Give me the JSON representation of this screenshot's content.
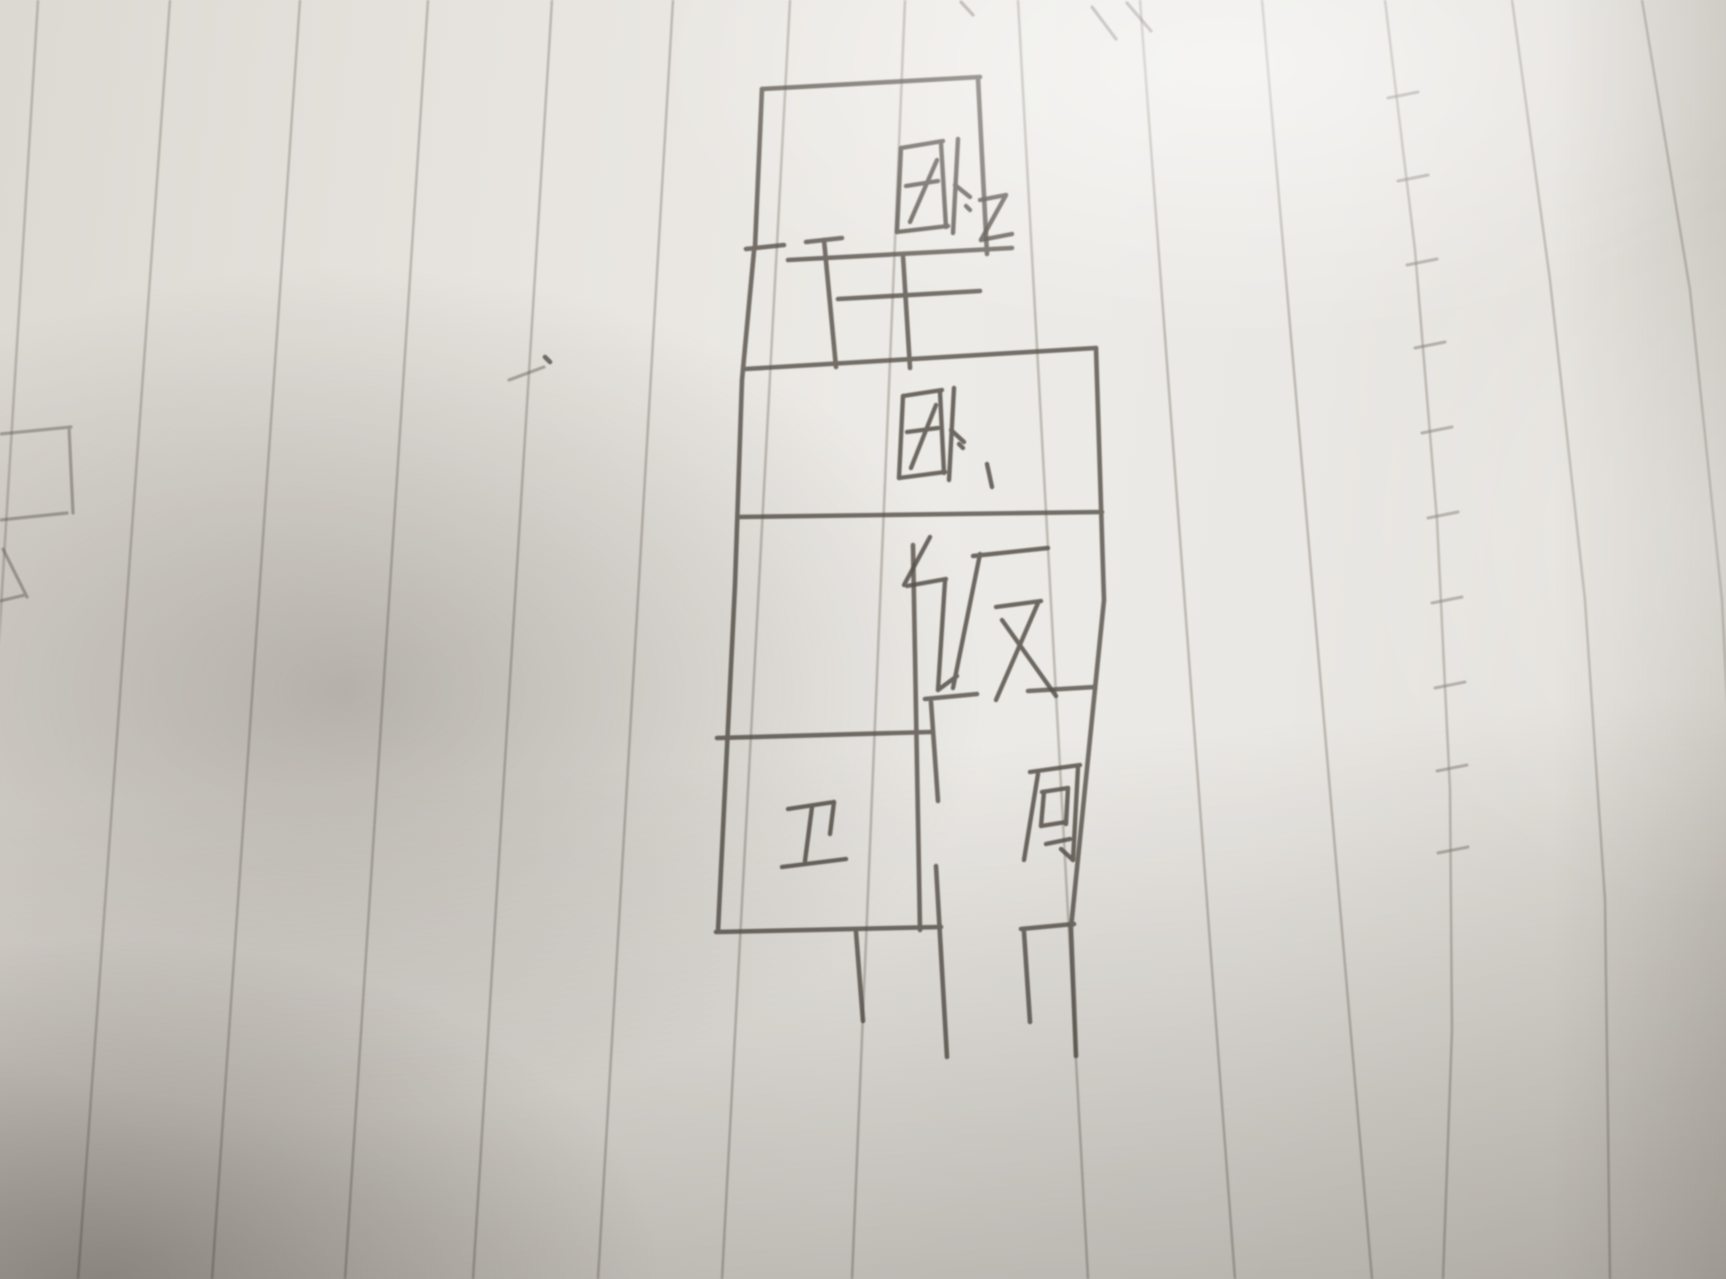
{
  "scene": {
    "description": "Photograph of a hand-drawn apartment floor plan sketched in pencil on slanted ruled notebook paper, with soft uneven lighting and shadow",
    "paper_color": "#eae8e4",
    "rule_line_color": "#a09a92",
    "pencil_color": "#58524b"
  },
  "floor_plan": {
    "rooms": [
      {
        "id": "bedroom-2",
        "label": "卧·2",
        "meaning": "Bedroom 2",
        "position": "top"
      },
      {
        "id": "bedroom-1",
        "label": "卧·1",
        "meaning": "Bedroom 1",
        "position": "upper middle"
      },
      {
        "id": "dining",
        "label": "饭",
        "meaning": "Dining",
        "position": "middle"
      },
      {
        "id": "bathroom",
        "label": "卫",
        "meaning": "Bathroom",
        "position": "lower left"
      },
      {
        "id": "kitchen",
        "label": "厨",
        "meaning": "Kitchen",
        "position": "lower right"
      }
    ]
  },
  "sketch": {
    "groups": [
      {
        "name": "rule-lines",
        "cls": "rule",
        "stroke_name": "rule-line",
        "lines": [
          [
            [
              38,
              0
            ],
            [
              -40,
              1279
            ]
          ],
          [
            [
              170,
              0
            ],
            [
              78,
              1279
            ]
          ],
          [
            [
              300,
              0
            ],
            [
              212,
              1279
            ]
          ],
          [
            [
              428,
              0
            ],
            [
              345,
              1279
            ]
          ],
          [
            [
              552,
              0
            ],
            [
              473,
              1279
            ]
          ],
          [
            [
              673,
              0
            ],
            [
              598,
              1279
            ]
          ],
          [
            [
              790,
              0
            ],
            [
              722,
              1279
            ]
          ],
          [
            [
              905,
              0
            ],
            [
              852,
              1279
            ]
          ],
          [
            [
              1018,
              0
            ],
            [
              1088,
              1279
            ]
          ],
          [
            [
              1140,
              0
            ],
            [
              1235,
              1279
            ]
          ],
          [
            [
              1262,
              0
            ],
            [
              1372,
              1279
            ]
          ],
          [
            [
              1385,
              0
            ],
            [
              1415,
              250
            ],
            [
              1437,
              520
            ],
            [
              1450,
              790
            ],
            [
              1452,
              1030
            ],
            [
              1443,
              1279
            ]
          ],
          [
            [
              1512,
              0
            ],
            [
              1550,
              280
            ],
            [
              1585,
              600
            ],
            [
              1605,
              900
            ],
            [
              1610,
              1279
            ]
          ],
          [
            [
              1642,
              0
            ],
            [
              1690,
              290
            ],
            [
              1722,
              600
            ],
            [
              1730,
              760
            ]
          ]
        ]
      },
      {
        "name": "seam-ticks",
        "cls": "rule-tick",
        "stroke_name": "seam-tick",
        "lines": [
          [
            [
              1388,
              98
            ],
            [
              1418,
              92
            ]
          ],
          [
            [
              1398,
              181
            ],
            [
              1428,
              175
            ]
          ],
          [
            [
              1407,
              265
            ],
            [
              1437,
              259
            ]
          ],
          [
            [
              1415,
              348
            ],
            [
              1445,
              342
            ]
          ],
          [
            [
              1422,
              433
            ],
            [
              1452,
              427
            ]
          ],
          [
            [
              1428,
              518
            ],
            [
              1458,
              512
            ]
          ],
          [
            [
              1432,
              603
            ],
            [
              1462,
              597
            ]
          ],
          [
            [
              1435,
              688
            ],
            [
              1465,
              682
            ]
          ],
          [
            [
              1437,
              771
            ],
            [
              1467,
              765
            ]
          ],
          [
            [
              1438,
              853
            ],
            [
              1468,
              847
            ]
          ]
        ]
      },
      {
        "name": "edge-marks",
        "cls": "pencil faint",
        "stroke_name": "edge-mark",
        "lines": [
          [
            [
              0,
              434
            ],
            [
              71,
              427
            ]
          ],
          [
            [
              69,
              427
            ],
            [
              73,
              513
            ]
          ],
          [
            [
              0,
              520
            ],
            [
              67,
              513
            ]
          ],
          [
            [
              3,
              549
            ],
            [
              27,
              597
            ]
          ],
          [
            [
              0,
              601
            ],
            [
              25,
              595
            ]
          ],
          [
            [
              509,
              380
            ],
            [
              544,
              367
            ]
          ],
          [
            [
              1092,
              7
            ],
            [
              1116,
              39
            ]
          ],
          [
            [
              1127,
              3
            ],
            [
              1151,
              31
            ]
          ],
          [
            [
              961,
              2
            ],
            [
              973,
              15
            ]
          ]
        ]
      },
      {
        "name": "smudge",
        "cls": "pencil wall",
        "stroke_name": "smudge-dot",
        "lines": [
          [
            [
              545,
              357
            ],
            [
              550,
              362
            ]
          ]
        ]
      },
      {
        "name": "walls",
        "cls": "pencil wall",
        "stroke_name": "wall-segment",
        "lines": [
          [
            [
              762,
              89
            ],
            [
              980,
              77
            ]
          ],
          [
            [
              978,
              78
            ],
            [
              987,
              254
            ]
          ],
          [
            [
              788,
              260
            ],
            [
              1012,
              248
            ]
          ],
          [
            [
              762,
              89
            ],
            [
              755,
              247
            ]
          ],
          [
            [
              746,
              249
            ],
            [
              784,
              245
            ]
          ],
          [
            [
              806,
              242
            ],
            [
              842,
              238
            ]
          ],
          [
            [
              824,
              240
            ],
            [
              836,
              367
            ]
          ],
          [
            [
              838,
              299
            ],
            [
              980,
              291
            ]
          ],
          [
            [
              903,
              256
            ],
            [
              910,
              368
            ]
          ],
          [
            [
              754,
              251
            ],
            [
              742,
              380
            ],
            [
              735,
              585
            ],
            [
              718,
              931
            ]
          ],
          [
            [
              745,
              369
            ],
            [
              1096,
              348
            ]
          ],
          [
            [
              1096,
              348
            ],
            [
              1104,
              600
            ],
            [
              1095,
              689
            ]
          ],
          [
            [
              739,
              517
            ],
            [
              1102,
              512
            ]
          ],
          [
            [
              913,
              545
            ],
            [
              920,
              930
            ]
          ],
          [
            [
              1028,
              691
            ],
            [
              1095,
              687
            ]
          ],
          [
            [
              1095,
              689
            ],
            [
              1071,
              928
            ],
            [
              1076,
              1056
            ]
          ],
          [
            [
              925,
              699
            ],
            [
              977,
              694
            ]
          ],
          [
            [
              931,
              702
            ],
            [
              938,
              801
            ]
          ],
          [
            [
              936,
              866
            ],
            [
              947,
              1057
            ]
          ],
          [
            [
              1021,
              929
            ],
            [
              1074,
              924
            ]
          ],
          [
            [
              1024,
              932
            ],
            [
              1030,
              1022
            ]
          ],
          [
            [
              717,
              738
            ],
            [
              931,
              732
            ]
          ],
          [
            [
              716,
              932
            ],
            [
              941,
              927
            ]
          ],
          [
            [
              856,
              932
            ],
            [
              863,
              1021
            ]
          ]
        ]
      },
      {
        "name": "label-bedroom-2",
        "cls": "pencil glyph",
        "stroke_name": "glyph-stroke",
        "lines": [
          [
            [
              901,
              148
            ],
            [
              943,
              141
            ]
          ],
          [
            [
              901,
              148
            ],
            [
              897,
              232
            ]
          ],
          [
            [
              897,
              232
            ],
            [
              948,
              226
            ]
          ],
          [
            [
              941,
              143
            ],
            [
              946,
              227
            ]
          ],
          [
            [
              906,
              186
            ],
            [
              938,
              181
            ]
          ],
          [
            [
              910,
              222
            ],
            [
              937,
              160
            ]
          ],
          [
            [
              958,
              139
            ],
            [
              953,
              233
            ]
          ],
          [
            [
              955,
              185
            ],
            [
              970,
              197
            ]
          ],
          [
            [
              966,
              206
            ],
            [
              970,
              210
            ]
          ],
          [
            [
              980,
              200
            ],
            [
              1006,
              195
            ]
          ],
          [
            [
              1006,
              195
            ],
            [
              981,
              240
            ]
          ],
          [
            [
              981,
              240
            ],
            [
              1012,
              234
            ]
          ]
        ]
      },
      {
        "name": "label-bedroom-1",
        "cls": "pencil glyph",
        "stroke_name": "glyph-stroke",
        "lines": [
          [
            [
              903,
              396
            ],
            [
              942,
              390
            ]
          ],
          [
            [
              903,
              396
            ],
            [
              899,
              478
            ]
          ],
          [
            [
              899,
              478
            ],
            [
              945,
              472
            ]
          ],
          [
            [
              940,
              392
            ],
            [
              944,
              473
            ]
          ],
          [
            [
              907,
              432
            ],
            [
              938,
              428
            ]
          ],
          [
            [
              911,
              468
            ],
            [
              936,
              405
            ]
          ],
          [
            [
              954,
              388
            ],
            [
              949,
              480
            ]
          ],
          [
            [
              951,
              430
            ],
            [
              964,
              442
            ]
          ],
          [
            [
              959,
              444
            ],
            [
              963,
              448
            ]
          ],
          [
            [
              987,
              464
            ],
            [
              992,
              487
            ]
          ]
        ]
      },
      {
        "name": "label-dining",
        "cls": "pencil glyph",
        "stroke_name": "glyph-stroke",
        "lines": [
          [
            [
              930,
              537
            ],
            [
              904,
              585
            ]
          ],
          [
            [
              907,
              586
            ],
            [
              946,
              579
            ]
          ],
          [
            [
              945,
              581
            ],
            [
              938,
              690
            ]
          ],
          [
            [
              938,
              690
            ],
            [
              957,
              676
            ]
          ],
          [
            [
              973,
              556
            ],
            [
              1048,
              548
            ]
          ],
          [
            [
              980,
              554
            ],
            [
              953,
              688
            ]
          ],
          [
            [
              996,
              607
            ],
            [
              1041,
              601
            ]
          ],
          [
            [
              1038,
              603
            ],
            [
              996,
              700
            ]
          ],
          [
            [
              1002,
              620
            ],
            [
              1056,
              696
            ]
          ]
        ]
      },
      {
        "name": "label-bathroom",
        "cls": "pencil glyph",
        "stroke_name": "glyph-stroke",
        "lines": [
          [
            [
              788,
              809
            ],
            [
              834,
              802
            ]
          ],
          [
            [
              834,
              802
            ],
            [
              830,
              834
            ]
          ],
          [
            [
              812,
              807
            ],
            [
              805,
              861
            ]
          ],
          [
            [
              782,
              867
            ],
            [
              846,
              859
            ]
          ]
        ]
      },
      {
        "name": "label-kitchen",
        "cls": "pencil glyph",
        "stroke_name": "glyph-stroke",
        "lines": [
          [
            [
              1030,
              772
            ],
            [
              1080,
              765
            ]
          ],
          [
            [
              1038,
              774
            ],
            [
              1024,
              860
            ]
          ],
          [
            [
              1042,
              792
            ],
            [
              1068,
              788
            ]
          ],
          [
            [
              1044,
              792
            ],
            [
              1041,
              826
            ]
          ],
          [
            [
              1068,
              788
            ],
            [
              1066,
              824
            ]
          ],
          [
            [
              1041,
              826
            ],
            [
              1066,
              822
            ]
          ],
          [
            [
              1046,
              844
            ],
            [
              1070,
              839
            ]
          ],
          [
            [
              1078,
              768
            ],
            [
              1073,
              860
            ]
          ],
          [
            [
              1073,
              860
            ],
            [
              1061,
              849
            ]
          ]
        ]
      }
    ]
  }
}
